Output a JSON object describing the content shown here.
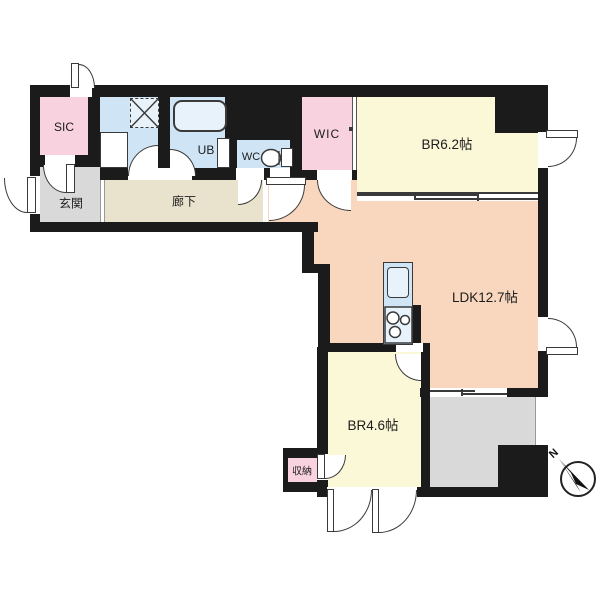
{
  "plan": {
    "rooms": {
      "sic": {
        "label": "SIC"
      },
      "entrance": {
        "label": "玄関"
      },
      "corridor": {
        "label": "廊下"
      },
      "ub": {
        "label": "UB"
      },
      "wc": {
        "label": "WC"
      },
      "wic": {
        "label": "WIC"
      },
      "br1": {
        "label": "BR6.2帖"
      },
      "ldk": {
        "label": "LDK12.7帖"
      },
      "br2": {
        "label": "BR4.6帖"
      },
      "storage": {
        "label": "収納"
      }
    },
    "compass": {
      "label": "N"
    }
  },
  "colors": {
    "wall": "#1b1b1b",
    "line": "#3a3a3a",
    "pink": "#f8d2de",
    "yellow": "#fbf8d8",
    "peach": "#f9d7bf",
    "beige": "#e9e2cd",
    "gray": "#d9d9d9",
    "water": "#cfe4f4",
    "waterLight": "#e7f2fb"
  }
}
